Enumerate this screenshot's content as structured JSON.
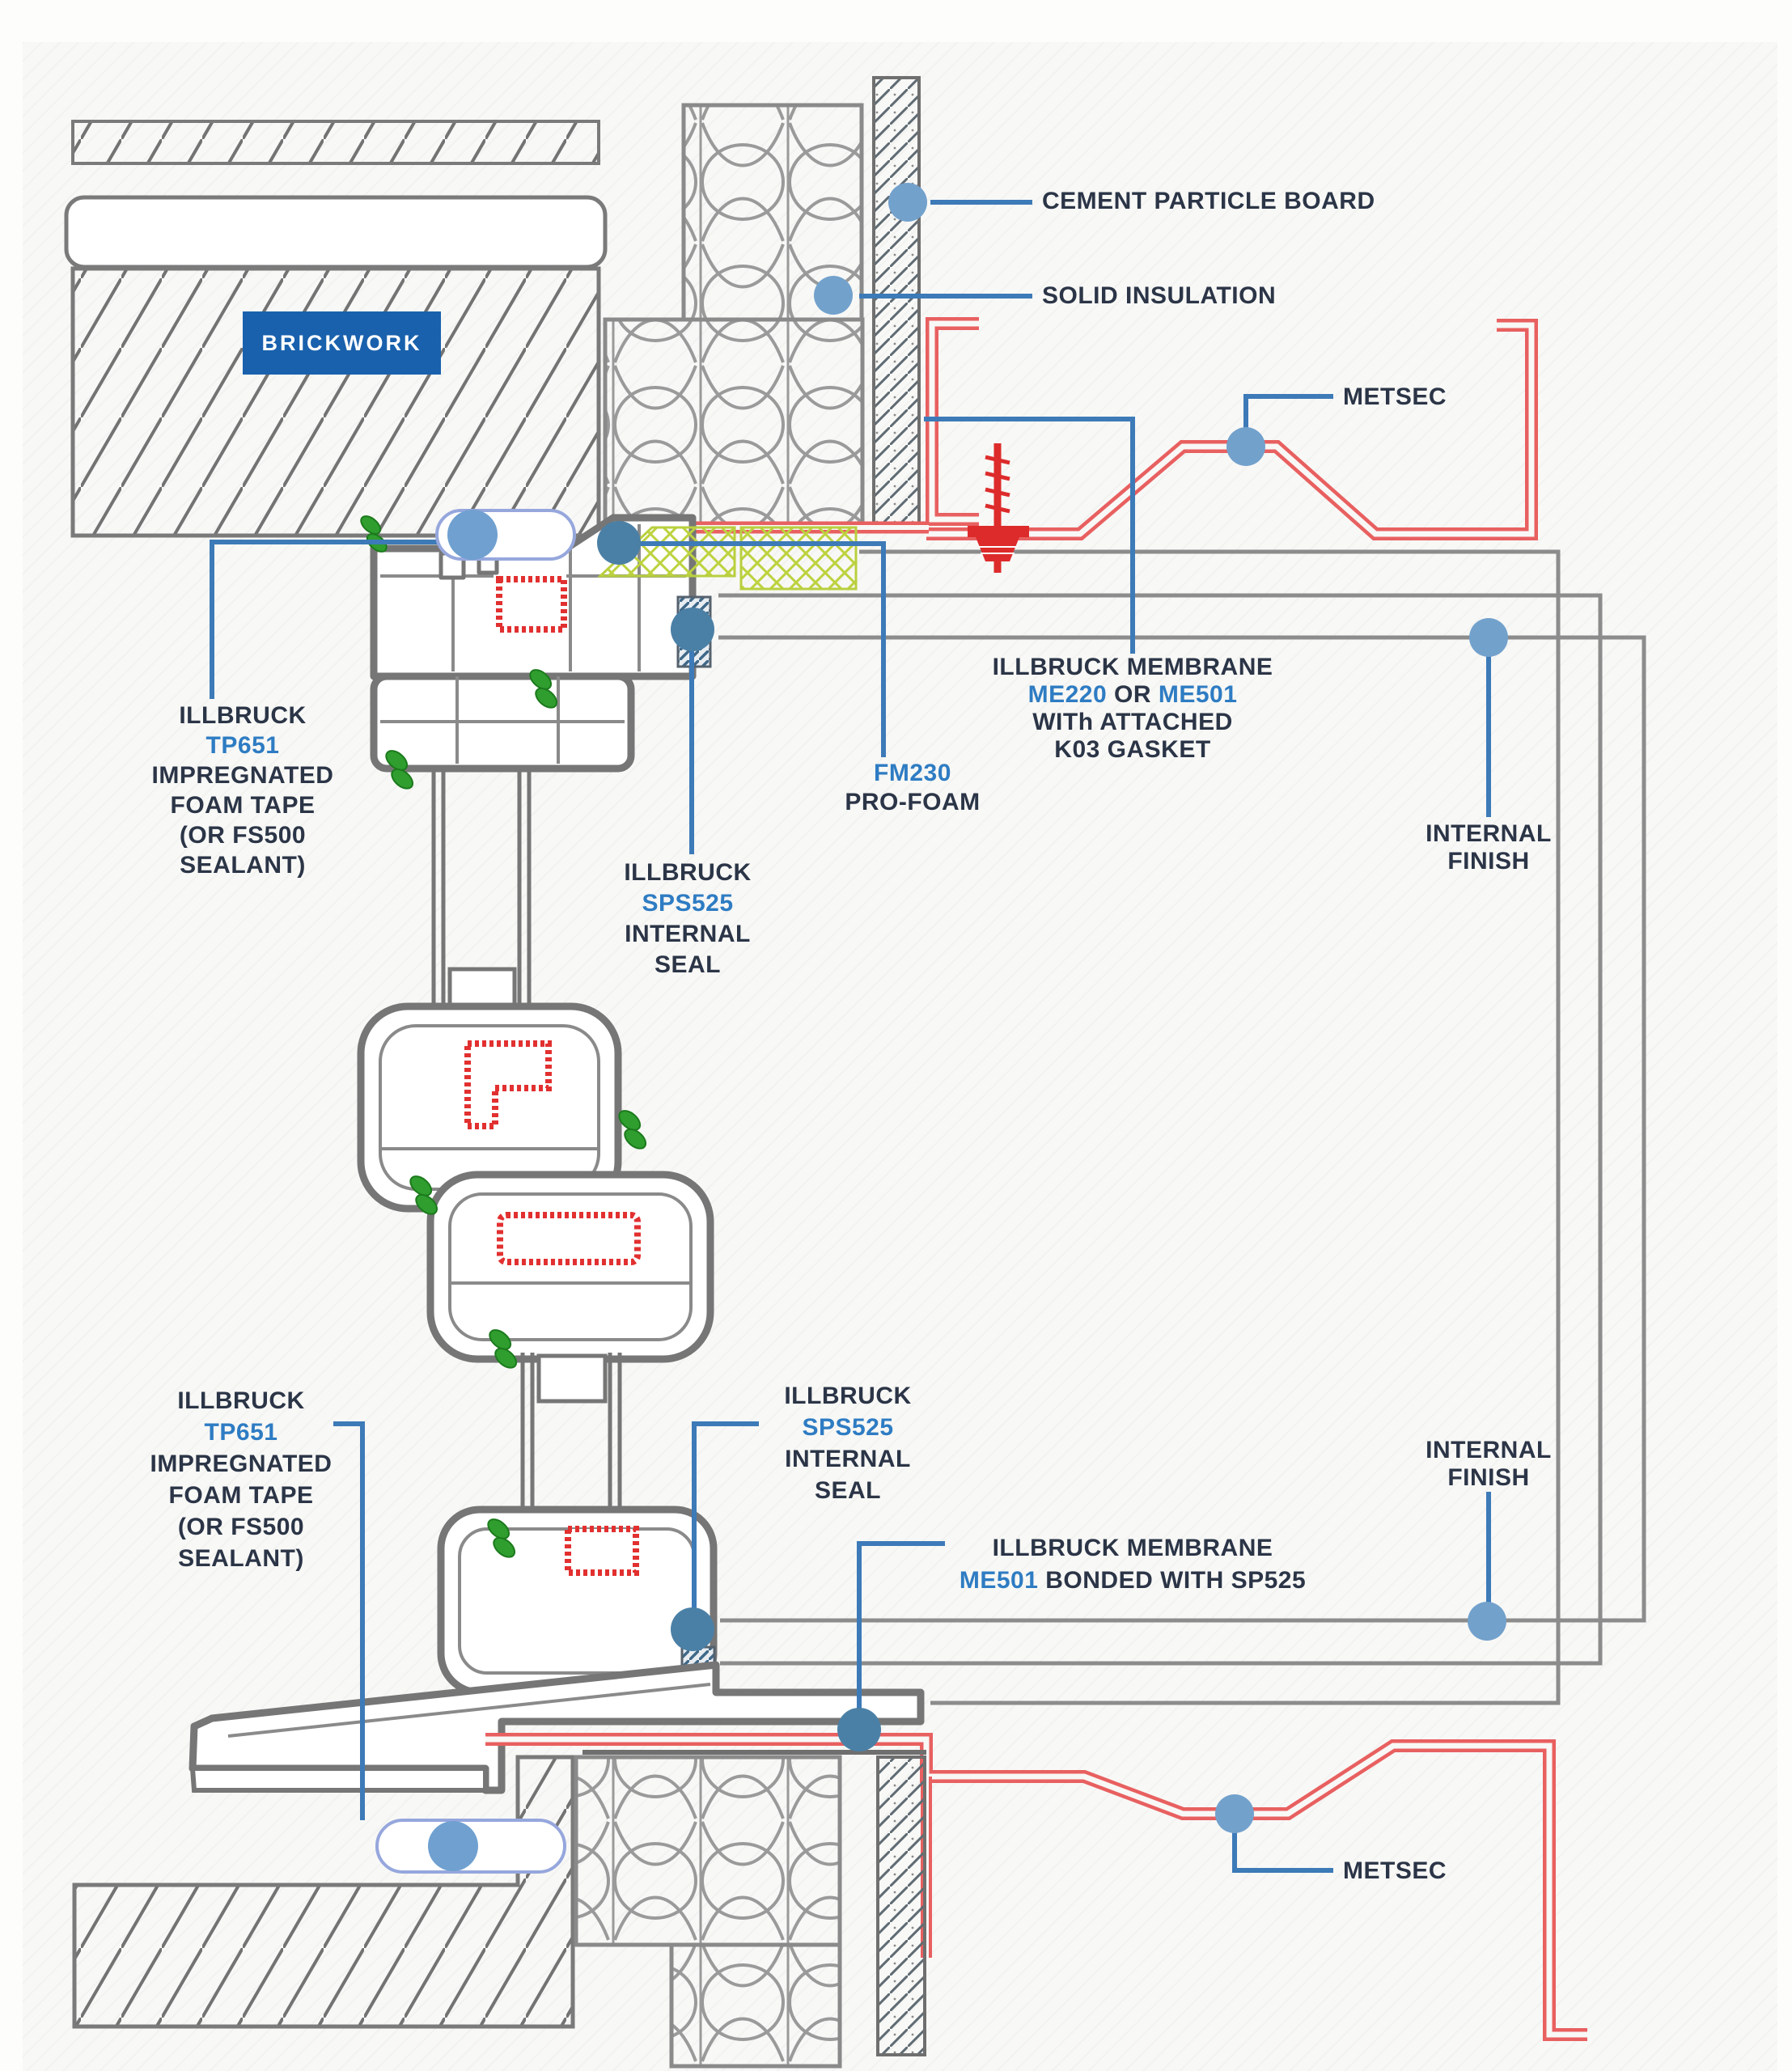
{
  "drawing_type": "window installation construction detail (head and sill section)",
  "colors": {
    "badge_blue": "#1961ad",
    "label_dark": "#2b3547",
    "label_blue": "#2e7cc3",
    "leader_blue": "#3d7ab8",
    "dot_blue": "#72a1cc",
    "seal_dot_blue": "#4b80a6",
    "red_profile": "#e86060",
    "red_reinforcement": "#e23030",
    "screw_red": "#dd2b2b",
    "green_gasket": "#2f9e2f",
    "foam_yellow_green": "#bdd23e",
    "frame_gray": "#767676",
    "finish_gray": "#8c8c8c",
    "brick_hatch_gray": "#737373"
  },
  "badge": {
    "text": "BRICKWORK"
  },
  "labels": {
    "cement_particle_board": {
      "text": "CEMENT PARTICLE BOARD"
    },
    "solid_insulation": {
      "text": "SOLID INSULATION"
    },
    "metsec_top": {
      "text": "METSEC"
    },
    "membrane_top": {
      "line1": "ILLBRUCK MEMBRANE",
      "line2_code1": "ME220",
      "line2_mid": " OR ",
      "line2_code2": "ME501",
      "line3": "WITh ATTACHED",
      "line4": "K03 GASKET"
    },
    "fm230": {
      "code": "FM230",
      "name": "PRO-FOAM"
    },
    "tp651_top": {
      "l1": "ILLBRUCK",
      "l2": "TP651",
      "l3": "IMPREGNATED",
      "l4": "FOAM TAPE",
      "l5": "(OR FS500",
      "l6": "SEALANT)"
    },
    "sps525_top": {
      "l1": "ILLBRUCK",
      "l2": "SPS525",
      "l3": "INTERNAL",
      "l4": "SEAL"
    },
    "internal_finish_top": {
      "l1": "INTERNAL",
      "l2": "FINISH"
    },
    "tp651_bottom": {
      "l1": "ILLBRUCK",
      "l2": "TP651",
      "l3": "IMPREGNATED",
      "l4": "FOAM TAPE",
      "l5": "(OR FS500",
      "l6": "SEALANT)"
    },
    "sps525_bottom": {
      "l1": "ILLBRUCK",
      "l2": "SPS525",
      "l3": "INTERNAL",
      "l4": "SEAL"
    },
    "membrane_bottom": {
      "line1": "ILLBRUCK MEMBRANE",
      "line2_code": "ME501",
      "line2_rest": " BONDED WITH SP525"
    },
    "internal_finish_bottom": {
      "l1": "INTERNAL",
      "l2": "FINISH"
    },
    "metsec_bottom": {
      "text": "METSEC"
    }
  }
}
